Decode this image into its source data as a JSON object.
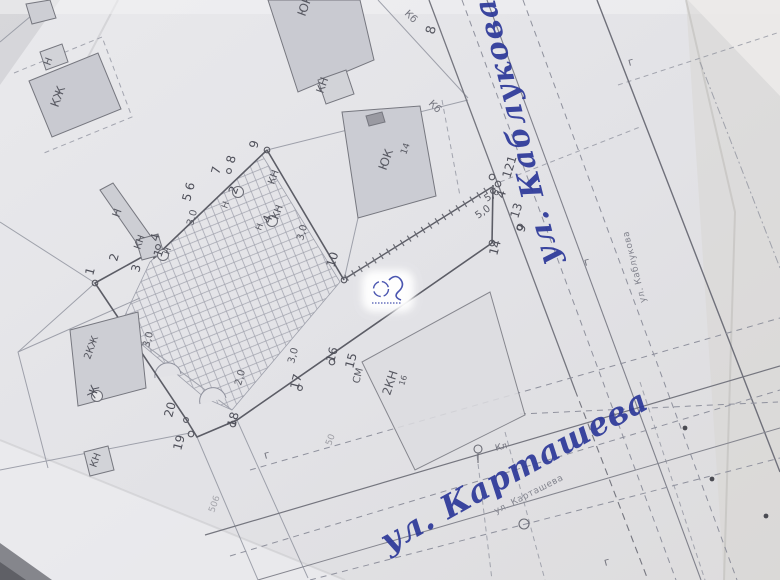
{
  "streets": {
    "kablukova_hand": "ул. Каблукова",
    "kartasheva_hand": "ул. Карташева",
    "kablukova_printed": "ул. Каблукова",
    "kartasheva_printed": "ул. Карташева"
  },
  "points": {
    "p1": "1",
    "p2": "2",
    "p3": "3",
    "p4": "4",
    "p5_6": "5 6",
    "p7": "7",
    "p8": "8",
    "p9": "9",
    "p10": "10",
    "p14": "14",
    "p15": "15",
    "p16": "16",
    "p17": "17",
    "p18": "18",
    "p19": "19",
    "p20": "20",
    "cluster_121": "121",
    "cluster_4": "4",
    "cluster_13": "13",
    "cluster_9": "9"
  },
  "dimensions": {
    "d3_0": "3,0",
    "d5_0": "5,0",
    "d5_6": "5,6",
    "d2_0": "2,0"
  },
  "buildings": {
    "kzh": "КЖ",
    "kzh2": "2КЖ",
    "kn": "КН",
    "kn2": "2КН",
    "kn2_idx": "16",
    "n": "Н",
    "yuk": "ЮК",
    "yuk_num": "14",
    "addr8": "8",
    "sm": "СМ",
    "f50": "50",
    "f506": "506"
  },
  "utilities": {
    "kb": "Кб",
    "kl": "Кл",
    "g": "г"
  },
  "wells": {
    "w1": "1",
    "w2": "2",
    "w4": "4",
    "wzh": "Ж"
  },
  "colors": {
    "ink": "#2c3899",
    "map_line": "#8f919d",
    "map_dark": "#5c5d66",
    "building_fill": "#c9cad1",
    "printed_text": "#83848e"
  }
}
